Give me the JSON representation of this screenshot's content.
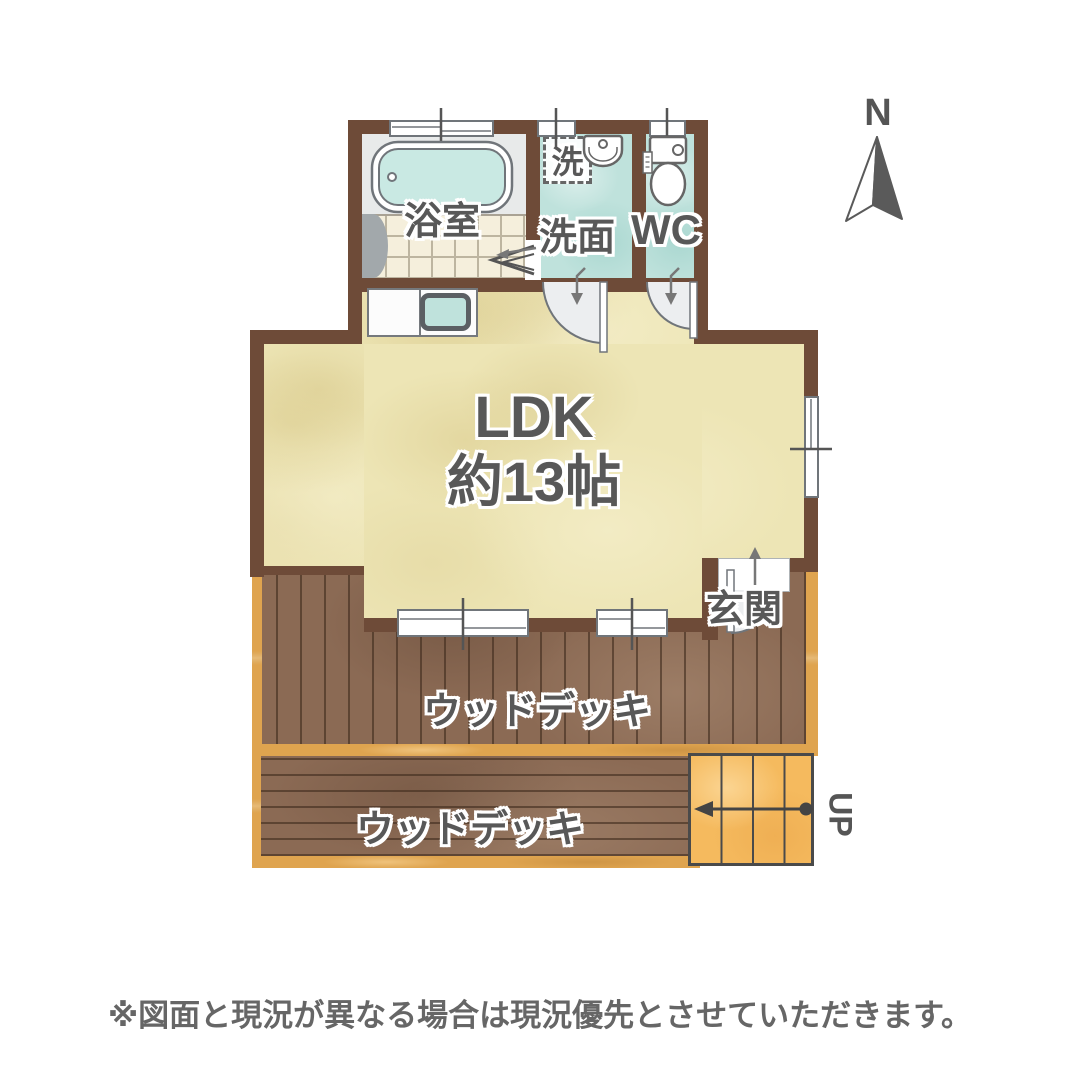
{
  "compass": {
    "label": "N"
  },
  "plan": {
    "bath": {
      "label": "浴室"
    },
    "laundry": {
      "label": "洗"
    },
    "washroom": {
      "label": "洗面"
    },
    "wc": {
      "label": "WC"
    },
    "ldk": {
      "line1": "LDK",
      "line2": "約13帖"
    },
    "entrance": {
      "label": "玄関"
    },
    "deck_upper": {
      "label": "ウッドデッキ"
    },
    "deck_lower": {
      "label": "ウッドデッキ"
    },
    "stairs": {
      "up_label": "UP"
    }
  },
  "footer": {
    "disclaimer": "※図面と現況が異なる場合は現況優先とさせていただきます。"
  },
  "colors": {
    "wall": "#6E4B38",
    "ldk_floor": "#EDE5B5",
    "wet_area_floor": "#BFE2DC",
    "bath_tile": "#F5EFDC",
    "wood_deck": "#8B6A54",
    "deck_trim": "#DFA44F",
    "stairs": "#F5BA5E",
    "text": "#585858"
  }
}
